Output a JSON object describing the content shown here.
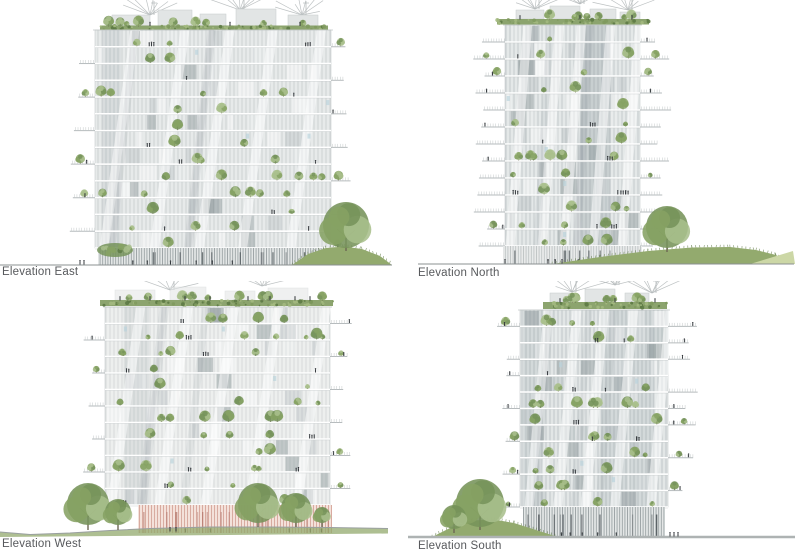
{
  "panels": [
    {
      "id": "east",
      "label": "Elevation East"
    },
    {
      "id": "north",
      "label": "Elevation North"
    },
    {
      "id": "west",
      "label": "Elevation West"
    },
    {
      "id": "south",
      "label": "Elevation South"
    }
  ],
  "colors": {
    "background": "#ffffff",
    "label_text": "#57595c",
    "ground_line": "#8b9091",
    "ground_line_thick": "#aeb3b3",
    "facade_base": "#e8ebeb",
    "facade_shade": "#8b9699",
    "stripe": "#9aa4a7",
    "floor_slab": "#ffffff",
    "floor_shadow": "#c3c8c9",
    "outline": "#c6cbcc",
    "canopy_line": "#b7bcbd",
    "roof_volume": "#e2e5e5",
    "roof_garden_dark": "#5d7a45",
    "roof_garden_mid": "#7f9a5e",
    "roof_garden_light": "#a3b97f",
    "tree_dark": "#76935a",
    "tree_mid": "#86a263",
    "tree_light": "#a9bf8c",
    "trunk": "#6d6753",
    "lawn": "#93aa6e",
    "lawn_light": "#ccd7a6",
    "grass_tick": "#5d7843",
    "pink_base": "#f4e1da",
    "pink_stripe": "#cf9b8e",
    "glass_accent": "#b9d2dc",
    "people": "#35393d"
  }
}
